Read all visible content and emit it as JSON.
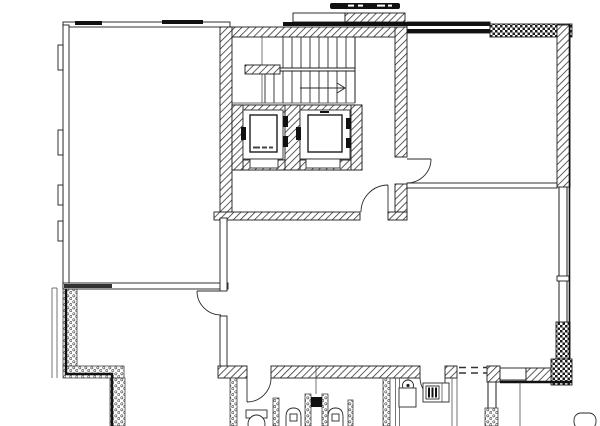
{
  "meta": {
    "title": "Architectural floor plan — building storey with central staircase and twin elevator core",
    "drawing_style": "black-and-white CAD line drawing, no legible text labels",
    "canvas": {
      "width_px": 600,
      "height_px": 426,
      "background": "#ffffff",
      "ink": "#1c1c1c"
    }
  },
  "plan": {
    "core": {
      "staircase": {
        "flights": 2,
        "treads_upper_flight": 8,
        "treads_lower_flight": 10,
        "direction_arrow": "points-right"
      },
      "elevators": {
        "count": 2,
        "cab_markings": "illegible micro-dashes"
      },
      "lobby_door_count": 2
    },
    "rooms": [
      {
        "name": "large-room-upper-left"
      },
      {
        "name": "room-upper-right"
      },
      {
        "name": "large-room-center"
      },
      {
        "name": "room-lower-left"
      },
      {
        "name": "sanitary-rooms-bottom",
        "fixtures": [
          "wc-toilet",
          "urinal",
          "urinal",
          "floor-drain-basin",
          "electrical-panel",
          "shower-tray"
        ]
      }
    ],
    "door_swing_arcs": 5,
    "wall_fill_patterns": [
      "diagonal-hatch",
      "checkerboard",
      "stipple-masonry"
    ],
    "window_indications": [
      "right-wall-lower-band",
      "top-left-wall-thick-marks",
      "bottom-right-wall-opening"
    ],
    "top_canopy": "hatched canopy strip above stair core with illegible dark header band",
    "dashed_lines": "double dashed opening line, bottom-right interior wall"
  }
}
